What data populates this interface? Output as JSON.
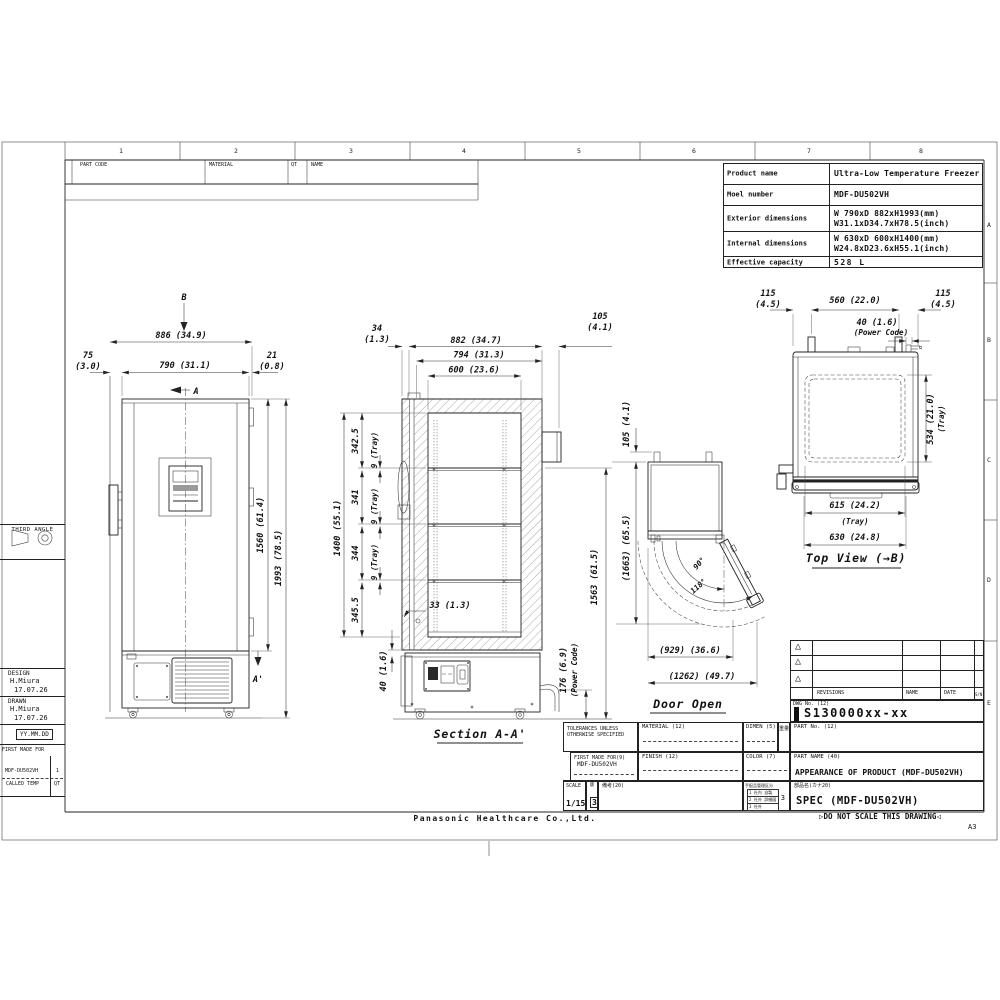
{
  "frame": {
    "zone_numbers": [
      "1",
      "2",
      "3",
      "4",
      "5",
      "6",
      "7",
      "8"
    ],
    "zone_letters": [
      "A",
      "B",
      "C",
      "D",
      "E"
    ]
  },
  "parts_band": {
    "part_code": "PART CODE",
    "material": "MATERIAL",
    "qt": "QT",
    "name": "NAME"
  },
  "product_table": {
    "rows": [
      {
        "label": "Product name",
        "line1": "Ultra-Low Temperature Freezer",
        "line2": ""
      },
      {
        "label": "Moel number",
        "line1": "MDF-DU502VH",
        "line2": ""
      },
      {
        "label": "Exterior dimensions",
        "line1": "W 790xD 882xH1993(mm)",
        "line2": "W31.1xD34.7xH78.5(inch)"
      },
      {
        "label": "Internal dimensions",
        "line1": "W 630xD 600xH1400(mm)",
        "line2": "W24.8xD23.6xH55.1(inch)"
      },
      {
        "label": "Effective capacity",
        "line1": "528 L",
        "line2": ""
      }
    ]
  },
  "left_panel": {
    "third_angle": "THIRD ANGLE",
    "design_label": "DESIGN",
    "design_name": "H.Miura",
    "design_date": "17.07.26",
    "drawn_label": "DRAWN",
    "drawn_name": "H.Miura",
    "drawn_date": "17.07.26",
    "date_format": "YY.MM.DD",
    "first_made_for": "FIRST MADE FOR",
    "model": "MDF-DU502VH",
    "model_qty": "1",
    "called_temp": "CALLED TEMP",
    "called_qt": "QT"
  },
  "views": {
    "front": {
      "arrow_b": "B",
      "arrow_a": "A",
      "arrow_a_prime": "A'",
      "dim_overall_w": "886 (34.9)",
      "dim_left_1": "75",
      "dim_left_2": "(3.0)",
      "dim_body_w": "790 (31.1)",
      "dim_right_1": "21",
      "dim_right_2": "(0.8)",
      "dim_door_h": "1560 (61.4)",
      "dim_overall_h": "1993 (78.5)"
    },
    "section": {
      "label": "Section A-A'",
      "dim_34_1": "34",
      "dim_34_2": "(1.3)",
      "dim_882": "882 (34.7)",
      "dim_794": "794 (31.3)",
      "dim_600": "600 (23.6)",
      "dim_105_1": "105",
      "dim_105_2": "(4.1)",
      "dim_1400": "1400 (55.1)",
      "dim_342": "342.5",
      "dim_341": "341",
      "dim_344": "344",
      "dim_345": "345.5",
      "dim_tray": "9 (Tray)",
      "dim_33": "33 (1.3)",
      "dim_40": "40 (1.6)",
      "dim_176": "176 (6.9)",
      "dim_power": "(Power Code)",
      "dim_1563": "1563 (61.5)"
    },
    "door_open": {
      "label": "Door Open",
      "dim_105": "105 (4.1)",
      "dim_1663": "(1663) (65.5)",
      "angle_90": "90°",
      "angle_118": "118°",
      "dim_929": "(929) (36.6)",
      "dim_1262": "(1262) (49.7)"
    },
    "top": {
      "label": "Top View (→B)",
      "dim_115l_1": "115",
      "dim_115l_2": "(4.5)",
      "dim_560": "560 (22.0)",
      "dim_115r_1": "115",
      "dim_115r_2": "(4.5)",
      "dim_40": "40 (1.6)",
      "dim_power": "(Power Code)",
      "dim_534": "534 (21.0)",
      "dim_534_tray": "(Tray)",
      "dim_615": "615 (24.2)",
      "dim_615_tray": "(Tray)",
      "dim_630": "630 (24.8)"
    }
  },
  "revisions": {
    "triangle": "△",
    "header_revisions": "REVISIONS",
    "header_name": "NAME",
    "header_date": "DATE",
    "header_sym": "S/N",
    "dwg_no_label": "DWG No. (12)",
    "dwg_no": "S130000xx-xx"
  },
  "title_block": {
    "tolerances_1": "TOLERANCES UNLESS",
    "tolerances_2": "OTHERWISE SPECIFIED",
    "material_label": "MATERIAL (12)",
    "dimen_label": "DIMEN (5)",
    "weight_label": "重量",
    "part_no_label": "PART No. (12)",
    "first_made_label": "FIRST MADE FOR(9)",
    "first_made_value": "MDF-DU502VH",
    "finish_label": "FINISH (12)",
    "color_label": "COLOR (7)",
    "part_name_label": "PART NAME (40)",
    "part_name_value": "APPEARANCE OF PRODUCT (MDF-DU502VH)",
    "scale_label": "SCALE",
    "scale_value": "1/15",
    "sheet_label": "版",
    "sheet_value": "3",
    "remarks_label": "備考(20)",
    "mgmt_label": "手配品管理区分",
    "mgmt_row1": "1 社内 自製",
    "mgmt_row2": "2 社外 詳細図",
    "mgmt_row3": "3 社外",
    "mgmt_value": "3",
    "item_name_label": "部品名(カナ20)",
    "item_name_value": "SPEC (MDF-DU502VH)"
  },
  "footer": {
    "company": "Panasonic Healthcare Co.,Ltd.",
    "marker_left": "▷",
    "do_not_scale": "DO NOT SCALE THIS DRAWING",
    "marker_right": "◁",
    "sheet_size": "A3"
  }
}
